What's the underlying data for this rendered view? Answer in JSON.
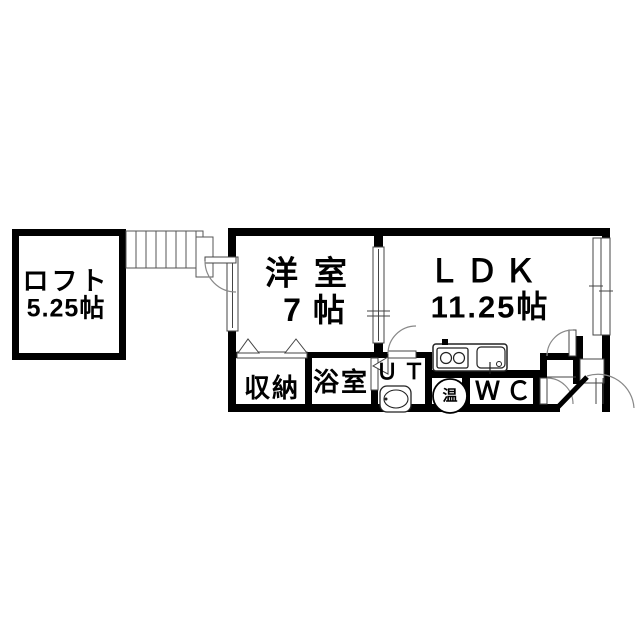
{
  "plan": {
    "type": "floorplan",
    "rooms": {
      "loft": {
        "label": "ロフト",
        "area": "5.25帖"
      },
      "western": {
        "label": "洋室",
        "area": "7帖"
      },
      "ldk": {
        "label": "ＬＤＫ",
        "area": "11.25帖"
      },
      "storage": {
        "label": "収納"
      },
      "bath": {
        "label": "浴室"
      },
      "utility": {
        "label": "ＵＴ"
      },
      "heater": {
        "label": "温"
      },
      "wc": {
        "label": "ＷＣ"
      }
    },
    "colors": {
      "wall": "#000000",
      "background": "#ffffff",
      "thin_line": "#444444",
      "arc_line": "#888888"
    }
  }
}
